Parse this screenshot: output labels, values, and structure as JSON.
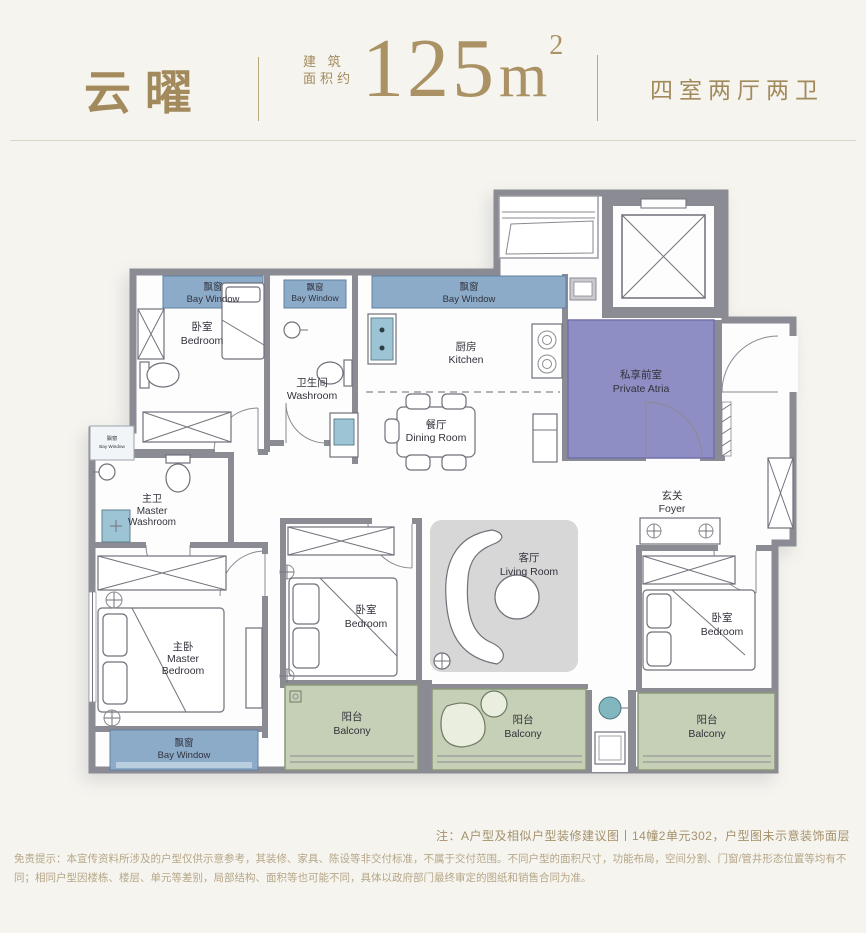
{
  "header": {
    "project_name": "云曜",
    "area_label_line1": "建 筑",
    "area_label_line2": "面积约",
    "area_value": "125",
    "area_unit": "m",
    "area_superscript": "2",
    "layout_spec": "四室两厅两卫"
  },
  "plan": {
    "rooms": {
      "bay_window_1": {
        "zh": "飘窗",
        "en": "Bay Window"
      },
      "bedroom_top": {
        "zh": "卧室",
        "en": "Bedroom"
      },
      "bay_window_2": {
        "zh": "飘窗",
        "en": "Bay Window"
      },
      "washroom": {
        "zh": "卫生间",
        "en": "Washroom"
      },
      "bay_window_3": {
        "zh": "飘窗",
        "en": "Bay Window"
      },
      "kitchen": {
        "zh": "厨房",
        "en": "Kitchen"
      },
      "dining_room": {
        "zh": "餐厅",
        "en": "Dining Room"
      },
      "private_atria": {
        "zh": "私享前室",
        "en": "Private Atria"
      },
      "foyer": {
        "zh": "玄关",
        "en": "Foyer"
      },
      "master_washroom": {
        "zh": "主卫",
        "en_line1": "Master",
        "en_line2": "Washroom"
      },
      "bay_window_side": {
        "zh": "飘窗",
        "en": "Bay Window"
      },
      "living_room": {
        "zh": "客厅",
        "en": "Living Room"
      },
      "master_bedroom": {
        "zh": "主卧",
        "en_line1": "Master",
        "en_line2": "Bedroom"
      },
      "bedroom_mid": {
        "zh": "卧室",
        "en": "Bedroom"
      },
      "bedroom_right": {
        "zh": "卧室",
        "en": "Bedroom"
      },
      "bay_window_bottom": {
        "zh": "飘窗",
        "en": "Bay Window"
      },
      "balcony_left": {
        "zh": "阳台",
        "en": "Balcony"
      },
      "balcony_mid": {
        "zh": "阳台",
        "en": "Balcony"
      },
      "balcony_right": {
        "zh": "阳台",
        "en": "Balcony"
      }
    }
  },
  "notes": {
    "plan_note": "注：A户型及相似户型装修建议图丨14幢2单元302，户型图未示意装饰面层",
    "disclaimer": "免责提示：本宣传资料所涉及的户型仅供示意参考，其装修、家具、陈设等非交付标准，不属于交付范围。不同户型的面积尺寸，功能布局，空间分割、门窗/管井形态位置等均有不同；相同户型因楼栋、楼层、单元等差别，局部结构、面积等也可能不同，具体以政府部门最终审定的图纸和销售合同为准。"
  },
  "colors": {
    "accent_gold": "#a28a5c",
    "bay_window_blue": "#8cabc9",
    "balcony_green": "#c5d0b6",
    "atria_purple": "#8f8ec4",
    "wall_gray": "#8b8b94"
  }
}
